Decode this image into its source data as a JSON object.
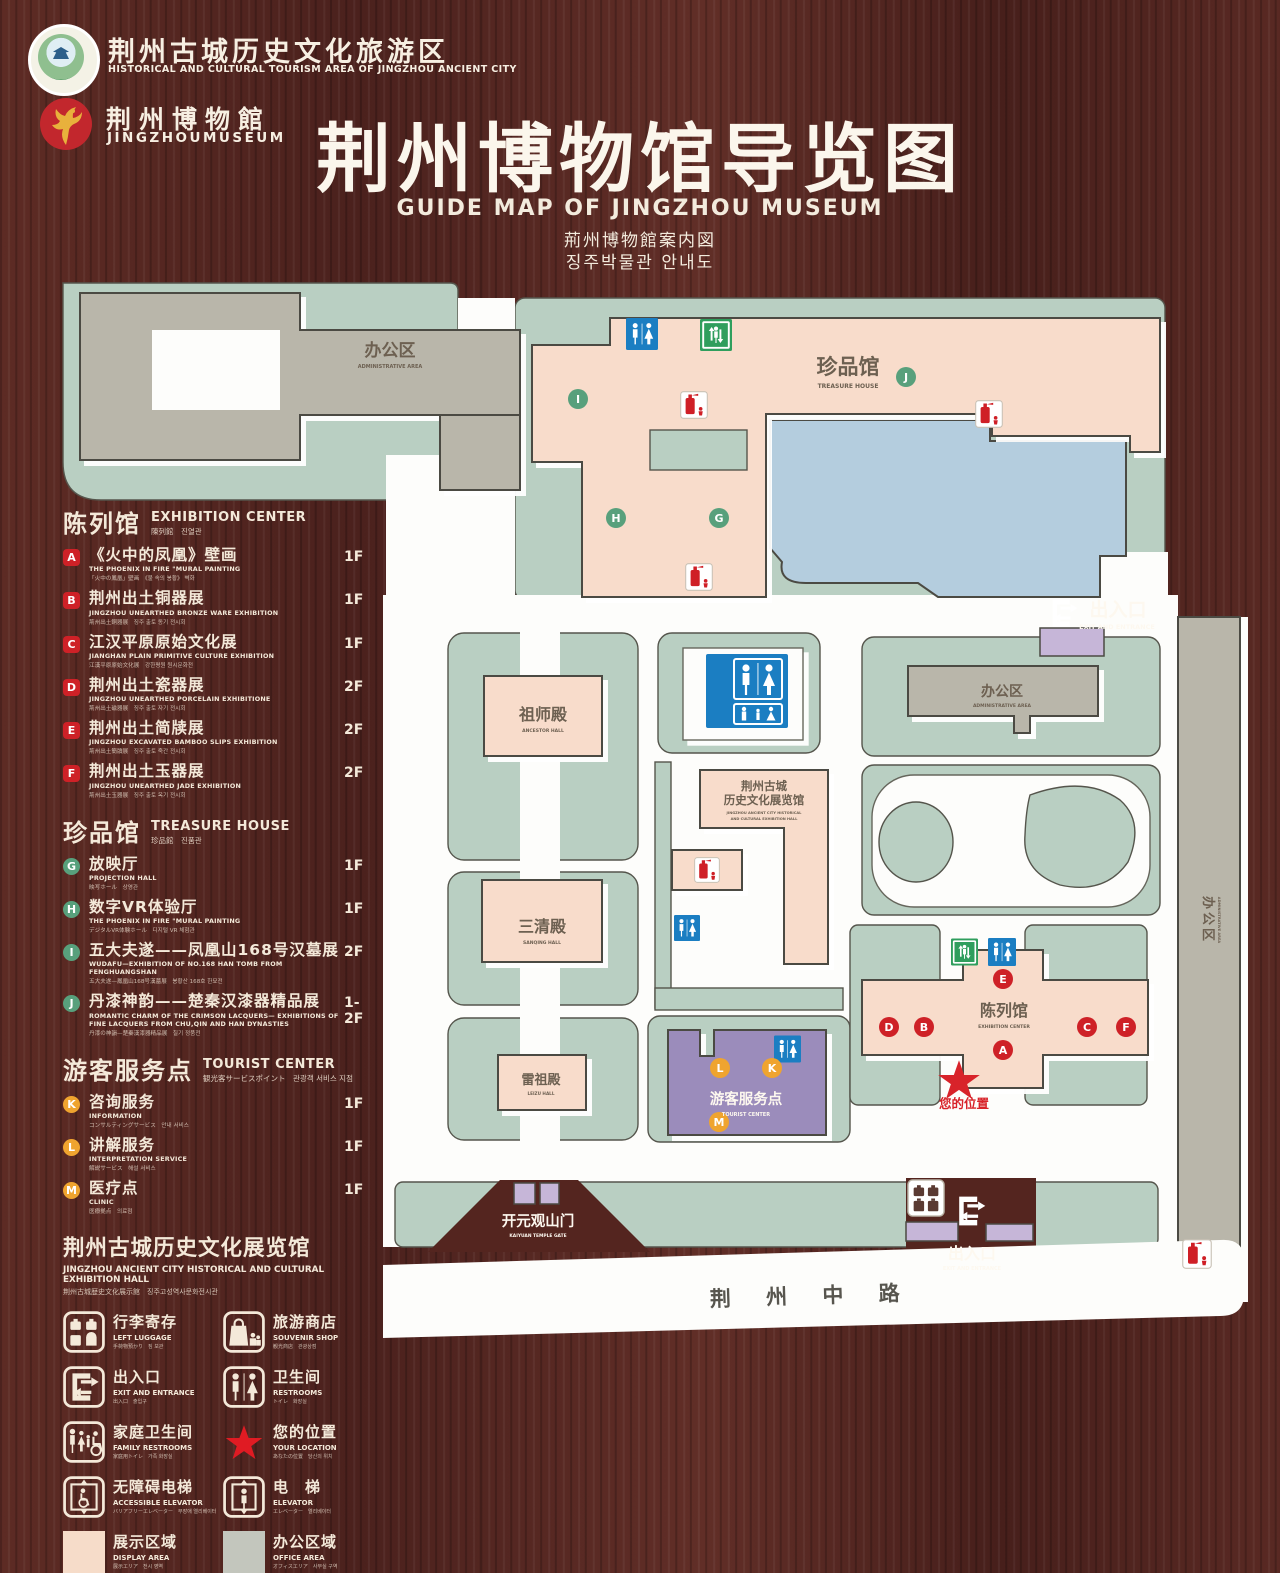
{
  "colors": {
    "wood": "#552621",
    "map_green": "#b9cfc2",
    "building_pink": "#f8dccb",
    "building_gray": "#b9b6aa",
    "tourist_purple": "#9b8cbb",
    "gate_purple": "#c6b6d8",
    "lake_blue": "#b4cdde",
    "badge_red": "#ce2127",
    "badge_green": "#58a07c",
    "badge_orange": "#efa42f",
    "restroom_blue": "#1b7ec2",
    "elevator_green": "#2f9e5d",
    "star_red": "#d8232a"
  },
  "header": {
    "emblem1_line1": "荆州古城历史文化旅游区",
    "emblem1_line2": "HISTORICAL AND CULTURAL TOURISM AREA OF JINGZHOU ANCIENT CITY",
    "emblem2_line1": "荆州博物館",
    "emblem2_line2": "JINGZHOUMUSEUM",
    "title": "荆州博物馆导览图",
    "subtitle_en": "GUIDE MAP OF JINGZHOU MUSEUM",
    "subtitle_ja": "荊州博物館案内図",
    "subtitle_ko": "징주박물관 안내도"
  },
  "legend": {
    "sections": [
      {
        "title_cn": "陈列馆",
        "title_en": "EXHIBITION CENTER",
        "title_sub": "陳列館　진열관",
        "items": [
          {
            "letter": "A",
            "cn": "《火中的凤凰》壁画",
            "en": "THE PHOENIX IN FIRE \"MURAL PAINTING",
            "sub": "「火中の鳳凰」壁画　《불 속의 봉황》 벽화",
            "floor": "1F"
          },
          {
            "letter": "B",
            "cn": "荆州出土铜器展",
            "en": "JINGZHOU UNEARTHED BRONZE WARE EXHIBITION",
            "sub": "荊州出土銅器展　징주 출토 동기 전시회",
            "floor": "1F"
          },
          {
            "letter": "C",
            "cn": "江汉平原原始文化展",
            "en": "JIANGHAN PLAIN PRIMITIVE CULTURE EXHIBITION",
            "sub": "江漢平原原始文化展　강한평원 원시문화전",
            "floor": "1F"
          },
          {
            "letter": "D",
            "cn": "荆州出土瓷器展",
            "en": "JINGZHOU UNEARTHED PORCELAIN EXHIBITIONE",
            "sub": "荊州出土磁器展　징주 출토 자기 전시회",
            "floor": "2F"
          },
          {
            "letter": "E",
            "cn": "荆州出土简牍展",
            "en": "JINGZHOU EXCAVATED BAMBOO SLIPS EXHIBITION",
            "sub": "荊州出土簡牘展　징주 출토 죽간 전시회",
            "floor": "2F"
          },
          {
            "letter": "F",
            "cn": "荆州出土玉器展",
            "en": "JINGZHOU UNEARTHED JADE EXHIBITION",
            "sub": "荊州出土玉器展　징주 출토 옥기 전시회",
            "floor": "2F"
          }
        ]
      },
      {
        "title_cn": "珍品馆",
        "title_en": "TREASURE HOUSE",
        "title_sub": "珍品館　진품관",
        "items": [
          {
            "letter": "G",
            "cn": "放映厅",
            "en": "PROJECTION HALL",
            "sub": "映写ホール　상영관",
            "floor": "1F"
          },
          {
            "letter": "H",
            "cn": "数字VR体验厅",
            "en": "THE PHOENIX IN FIRE \"MURAL PAINTING",
            "sub": "デジタルVR体験ホール　디지털 VR 체험관",
            "floor": "1F"
          },
          {
            "letter": "I",
            "cn": "五大夫遂——凤凰山168号汉墓展",
            "en": "WUDAFU—EXHIBITION OF NO.168 HAN TOMB FROM FENGHUANGSHAN",
            "sub": "五大夫遂—鳳凰山168号漢墓展　봉황산 168호 한묘전",
            "floor": "2F"
          },
          {
            "letter": "J",
            "cn": "丹漆神韵——楚秦汉漆器精品展",
            "en": "ROMANTIC CHARM OF THE CRIMSON LACQUERS— EXHIBITIONS OF FINE LACQUERS FROM CHU,QIN AND HAN DYNASTIES",
            "sub": "丹漆の神韻—楚秦漢漆器精品展　칠기 정품전",
            "floor": "1-2F"
          }
        ]
      },
      {
        "title_cn": "游客服务点",
        "title_en": "TOURIST CENTER",
        "title_sub": "観光客サービスポイント　관광객 서비스 지점",
        "items": [
          {
            "letter": "K",
            "cn": "咨询服务",
            "en": "INFORMATION",
            "sub": "コンサルティングサービス　안내 서비스",
            "floor": "1F"
          },
          {
            "letter": "L",
            "cn": "讲解服务",
            "en": "INTERPRETATION SERVICE",
            "sub": "解説サービス　해설 서비스",
            "floor": "1F"
          },
          {
            "letter": "M",
            "cn": "医疗点",
            "en": "CLINIC",
            "sub": "医療拠点　의료점",
            "floor": "1F"
          }
        ]
      }
    ],
    "hall_note": {
      "cn": "荆州古城历史文化展览馆",
      "en": "JINGZHOU ANCIENT CITY HISTORICAL AND CULTURAL EXHIBITION HALL",
      "sub": "荆州古城歴史文化展示館　징주고성역사문화전시관"
    },
    "icons": [
      {
        "icon": "luggage",
        "cn": "行李寄存",
        "en": "LEFT LUGGAGE",
        "sub": "手荷物預かり　짐 보관"
      },
      {
        "icon": "shop",
        "cn": "旅游商店",
        "en": "SOUVENIR SHOP",
        "sub": "観光商店　관광상점"
      },
      {
        "icon": "exit",
        "cn": "出入口",
        "en": "EXIT AND ENTRANCE",
        "sub": "出入口　출입구"
      },
      {
        "icon": "restroom",
        "cn": "卫生间",
        "en": "RESTROOMS",
        "sub": "トイレ　화장실"
      },
      {
        "icon": "family",
        "cn": "家庭卫生间",
        "en": "FAMILY RESTROOMS",
        "sub": "家庭用トイレ　가족 화장실"
      },
      {
        "icon": "star",
        "cn": "您的位置",
        "en": "YOUR LOCATION",
        "sub": "あなたの位置　당신의 위치"
      },
      {
        "icon": "accelev",
        "cn": "无障碍电梯",
        "en": "ACCESSIBLE ELEVATOR",
        "sub": "バリアフリーエレベーター　무장애 엘리베이터"
      },
      {
        "icon": "elev",
        "cn": "电　梯",
        "en": "ELEVATOR",
        "sub": "エレベーター　엘리베이터"
      },
      {
        "icon": "display",
        "cn": "展示区域",
        "en": "DISPLAY AREA",
        "sub": "展示エリア　전시 영역"
      },
      {
        "icon": "office",
        "cn": "办公区域",
        "en": "OFFICE AREA",
        "sub": "オフィスエリア　사무실 구역"
      }
    ]
  },
  "map": {
    "labels": {
      "admin_top_cn": "办公区",
      "admin_top_en": "ADMINISTRATIVE AREA",
      "treasure_cn": "珍品馆",
      "treasure_en": "TREASURE HOUSE",
      "exit_top_cn": "出入口",
      "exit_top_en": "EXIT AND ENTRANCE",
      "admin_right_cn": "办公区",
      "admin_right_en": "ADMINISTRATIVE AREA",
      "admin_strip_cn": "办公区",
      "admin_strip_en": "ADMINISTRATIVE AREA",
      "ancestor_cn": "祖师殿",
      "ancestor_en": "ANCESTOR HALL",
      "sanqing_cn": "三清殿",
      "sanqing_en": "SANQING HALL",
      "leizu_cn": "雷祖殿",
      "leizu_en": "LEIZU HALL",
      "hall_cn1": "荆州古城",
      "hall_cn2": "历史文化展览馆",
      "hall_en1": "JINGZHOU ANCIENT CITY HISTORICAL",
      "hall_en2": "AND CULTURAL EXHIBITION HALL",
      "exhibition_cn": "陈列馆",
      "exhibition_en": "EXHIBITION CENTER",
      "tourist_cn": "游客服务点",
      "tourist_en": "TOURIST CENTER",
      "location": "您的位置",
      "gate_cn": "开元观山门",
      "gate_en": "KAIYUAN TEMPLE GATE",
      "exit_bottom_cn": "出入口",
      "exit_bottom_en": "EXIT AND ENTRANCE",
      "road": "荆 州 中 路"
    },
    "badges": [
      {
        "letter": "I",
        "x": 578,
        "y": 399,
        "group": "green"
      },
      {
        "letter": "J",
        "x": 906,
        "y": 377,
        "group": "green"
      },
      {
        "letter": "H",
        "x": 616,
        "y": 518,
        "group": "green"
      },
      {
        "letter": "G",
        "x": 719,
        "y": 518,
        "group": "green"
      },
      {
        "letter": "E",
        "x": 1003,
        "y": 979,
        "group": "red"
      },
      {
        "letter": "D",
        "x": 889,
        "y": 1027,
        "group": "red"
      },
      {
        "letter": "B",
        "x": 924,
        "y": 1027,
        "group": "red"
      },
      {
        "letter": "C",
        "x": 1087,
        "y": 1027,
        "group": "red"
      },
      {
        "letter": "F",
        "x": 1126,
        "y": 1027,
        "group": "red"
      },
      {
        "letter": "A",
        "x": 1003,
        "y": 1050,
        "group": "red"
      },
      {
        "letter": "L",
        "x": 720,
        "y": 1068,
        "group": "orange"
      },
      {
        "letter": "K",
        "x": 772,
        "y": 1068,
        "group": "orange"
      },
      {
        "letter": "M",
        "x": 719,
        "y": 1122,
        "group": "orange"
      }
    ],
    "icons": [
      {
        "type": "wc",
        "x": 624,
        "y": 318,
        "w": 36,
        "h": 32
      },
      {
        "type": "elev",
        "x": 700,
        "y": 319,
        "w": 32,
        "h": 32
      },
      {
        "type": "ext",
        "x": 680,
        "y": 390,
        "w": 28,
        "h": 30
      },
      {
        "type": "ext",
        "x": 975,
        "y": 399,
        "w": 28,
        "h": 30
      },
      {
        "type": "ext",
        "x": 685,
        "y": 562,
        "w": 28,
        "h": 30
      },
      {
        "type": "wcbig",
        "x": 706,
        "y": 654,
        "w": 82,
        "h": 74
      },
      {
        "type": "ext",
        "x": 694,
        "y": 856,
        "w": 26,
        "h": 28
      },
      {
        "type": "wc",
        "x": 674,
        "y": 912,
        "w": 26,
        "h": 32
      },
      {
        "type": "wc",
        "x": 774,
        "y": 1035,
        "w": 27,
        "h": 28
      },
      {
        "type": "elev",
        "x": 951,
        "y": 938,
        "w": 27,
        "h": 28
      },
      {
        "type": "wc",
        "x": 988,
        "y": 938,
        "w": 28,
        "h": 28
      },
      {
        "type": "exitw",
        "x": 1044,
        "y": 596,
        "w": 38,
        "h": 34
      },
      {
        "type": "lugw",
        "x": 906,
        "y": 1179,
        "w": 40,
        "h": 38
      },
      {
        "type": "exitw",
        "x": 952,
        "y": 1193,
        "w": 36,
        "h": 36
      },
      {
        "type": "ext",
        "x": 1182,
        "y": 1239,
        "w": 30,
        "h": 30
      },
      {
        "type": "star",
        "x": 936,
        "y": 1058,
        "w": 46,
        "h": 44
      }
    ]
  }
}
